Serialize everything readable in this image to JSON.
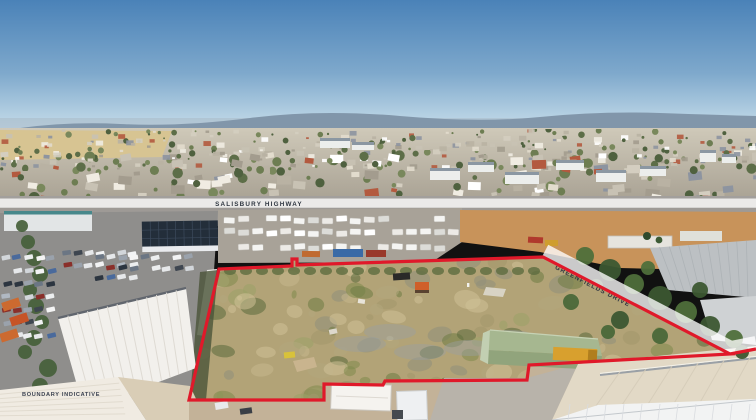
{
  "photo": {
    "labels": {
      "highway": "SALISBURY HIGHWAY",
      "drive": "GREENFIELDS DRIVE",
      "disclaimer": "BOUNDARY INDICATIVE"
    },
    "colors": {
      "boundary_red": "#e0192a",
      "road_band_white": "rgba(255,255,255,0.78)",
      "label_text": "#2e3641",
      "sky_top": "#4a82b8",
      "sky_horizon": "#cadfec",
      "shed_green": "#a6b790",
      "dry_grass_tan": "#d7c492"
    }
  }
}
